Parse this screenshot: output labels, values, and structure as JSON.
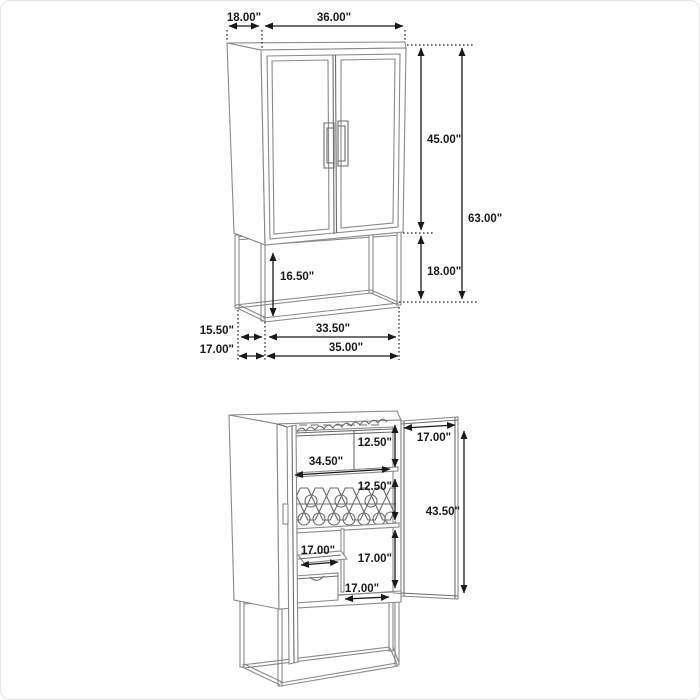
{
  "page": {
    "description": "Bar cabinet dimension diagram, two views",
    "colors": {
      "background": "#ffffff",
      "border": "#e4e4e4",
      "structure_line": "#8a8a8a",
      "dimension_line": "#1a1a1a",
      "dimension_text": "#1a1a1a"
    }
  },
  "figures": {
    "closed": {
      "name": "closed cabinet front view",
      "top_depth": "18.00\"",
      "top_width": "36.00\"",
      "upper_height": "45.00\"",
      "total_height": "63.00\"",
      "base_height": "18.00\"",
      "base_inner_height": "16.50\"",
      "base_inner_depth": "15.50\"",
      "base_outer_depth": "17.00\"",
      "base_inner_width": "33.50\"",
      "base_outer_width": "35.00\""
    },
    "open": {
      "name": "open cabinet interior view",
      "top_section_height": "12.50\"",
      "shelf_width": "34.50\"",
      "rack_section_height": "12.50\"",
      "door_width": "17.00\"",
      "door_height": "43.50\"",
      "tray_width": "17.00\"",
      "lower_section_height": "17.00\"",
      "bottom_width": "17.00\""
    }
  }
}
